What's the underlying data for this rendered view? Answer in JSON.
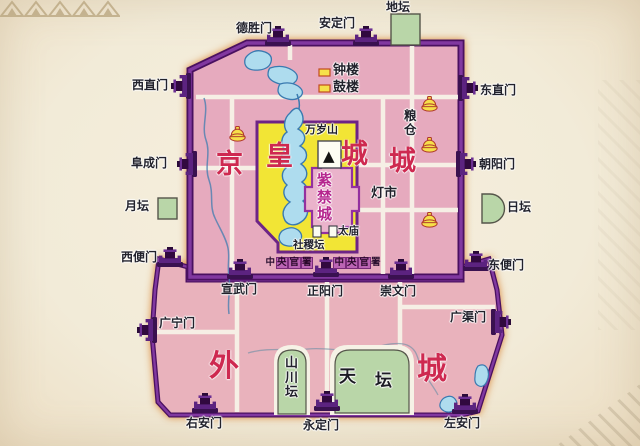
{
  "map_title_note": "明清北京城地图",
  "regions": {
    "jingcheng": {
      "chars": [
        "京",
        "城"
      ]
    },
    "huangcheng": {
      "chars": [
        "皇",
        "城"
      ]
    },
    "zijincheng": {
      "chars": [
        "紫",
        "禁",
        "城"
      ]
    },
    "waicheng": {
      "chars": [
        "外",
        "城"
      ]
    }
  },
  "gates": {
    "deshengmen": "德胜门",
    "andingmen": "安定门",
    "xizhimen": "西直门",
    "dongzhimen": "东直门",
    "fuchengmen": "阜成门",
    "chaoyangmen": "朝阳门",
    "xibianmen": "西便门",
    "dongbianmen": "东便门",
    "xuanwumen": "宣武门",
    "zhengyangmen": "正阳门",
    "chongwenmen": "崇文门",
    "guangningmen": "广宁门",
    "guangqumen": "广渠门",
    "youanmen": "右安门",
    "yongdingmen": "永定门",
    "zuoanmen": "左安门"
  },
  "altars": {
    "ditan": "地坛",
    "yuetan": "月坛",
    "ritan": "日坛",
    "shejitan": "社稷坛",
    "taimiao": "太庙",
    "shanchuantan": {
      "chars": [
        "山",
        "川",
        "坛"
      ]
    },
    "tiantan": {
      "chars": [
        "天",
        "坛"
      ]
    }
  },
  "landmarks": {
    "zhonglou": "钟楼",
    "gulou": "鼓楼",
    "wansuishan": "万岁山",
    "wansuishan_marker": "▲",
    "liangcang": {
      "chars": [
        "粮",
        "仓"
      ]
    },
    "dengshi": "灯市",
    "zhongyang_guanshu_west": {
      "chars": [
        "中",
        "央",
        "官",
        "署"
      ]
    },
    "zhongyang_guanshu_east": {
      "chars": [
        "中",
        "央",
        "官",
        "署"
      ]
    }
  },
  "icons": {
    "city_gate": "city-gate-icon",
    "granary": "granary-basket-icon",
    "tower_legend": "tower-marker-icon",
    "altar_building": "altar-building-icon",
    "mountain": "mountain-triangle-icon"
  },
  "colors": {
    "wall_purple": "#6d2486",
    "wall_purple_dark": "#4a1060",
    "inner_city_pink": "#e6aabe",
    "outer_city_pink": "#e9b2bc",
    "imperial_yellow": "#f2e535",
    "forbidden_pink": "#eab3cb",
    "altar_green": "#b9d6a8",
    "water_blue": "#aedcee",
    "region_label_red": "#ce2950",
    "road_white": "#f7f3e8",
    "page_cream": "#f3ecd8",
    "glow_orange": "#dd8a3f"
  }
}
